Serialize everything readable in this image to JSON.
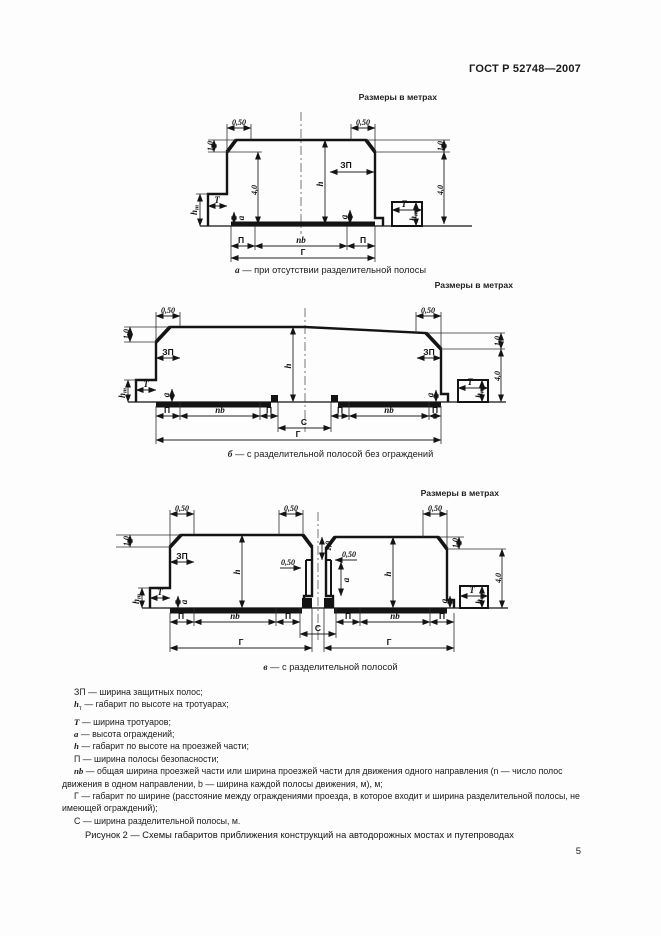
{
  "page": {
    "header": "ГОСТ Р 52748—2007",
    "number": "5"
  },
  "units_label": "Размеры в метрах",
  "diagram_captions": {
    "a": {
      "letter": "а",
      "text": "—  при отсутствии разделительной полосы"
    },
    "b": {
      "letter": "б",
      "text": "—  с разделительной полосой без ограждений"
    },
    "v": {
      "letter": "в",
      "text": "—  с разделительной полосой"
    }
  },
  "sym": {
    "d050": "0,50",
    "d10": "1,0",
    "d40": "4,0",
    "h": "h",
    "t_sub": "т",
    "T": "Т",
    "zp": "ЗП",
    "a": "а",
    "P": "П",
    "nb": "nb",
    "G": "Г",
    "C": "С"
  },
  "legend": {
    "items": [
      {
        "term": "ЗП",
        "sub": "",
        "text": "—  ширина защитных полос;"
      },
      {
        "term": "h",
        "sub": "т",
        "text": "—  габарит по высоте на тротуарах;"
      },
      {
        "term": "Т",
        "sub": "",
        "text": "—  ширина тротуаров;"
      },
      {
        "term": "а",
        "sub": "",
        "text": "—  высота ограждений;"
      },
      {
        "term": "h",
        "sub": "",
        "text": "—  габарит по высоте на проезжей части;"
      },
      {
        "term": "П",
        "sub": "",
        "text": "—  ширина полосы безопасности;"
      },
      {
        "term": "nb",
        "sub": "",
        "text": "—  общая ширина проезжей части или ширина проезжей части для движения одного направления (n — число полос движения в одном направлении, b — ширина каждой полосы движения, м), м;"
      },
      {
        "term": "Г",
        "sub": "",
        "text": "— габарит по ширине (расстояние между ограждениями проезда, в которое входит и ширина разделительной полосы, не имеющей ограждений);"
      },
      {
        "term": "С",
        "sub": "",
        "text": "—  ширина разделительной полосы, м."
      }
    ]
  },
  "figure_caption": "Рисунок 2 — Схемы габаритов приближения конструкций на автодорожных мостах и путепроводах"
}
